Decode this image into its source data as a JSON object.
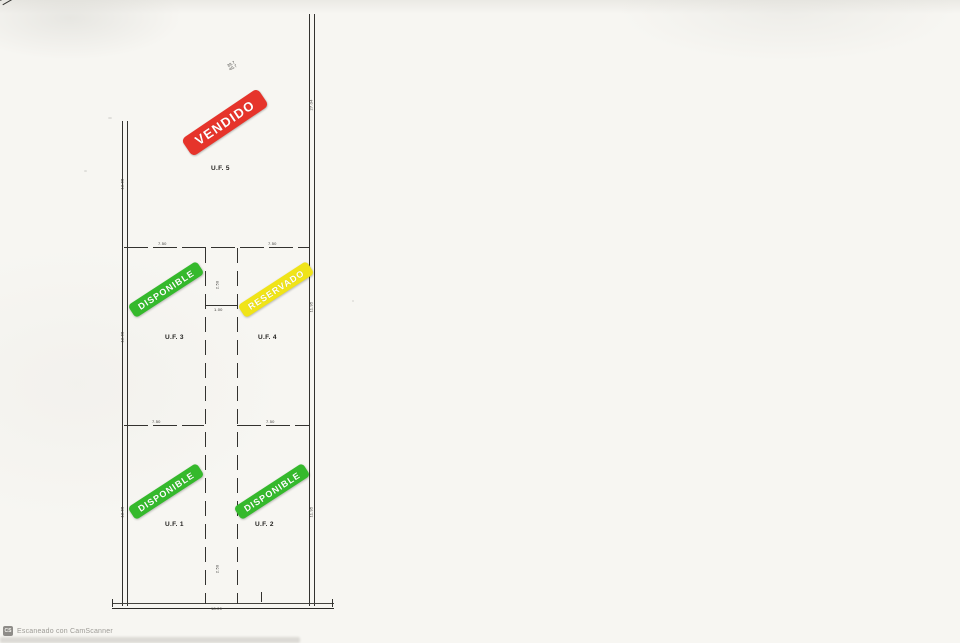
{
  "watermark": {
    "icon_text": "CS",
    "text": "Escaneado con CamScanner"
  },
  "plan": {
    "units": [
      {
        "id": "uf5",
        "label": "U.F. 5",
        "status": "VENDIDO",
        "status_color": "#e6342b"
      },
      {
        "id": "uf3",
        "label": "U.F. 3",
        "status": "DISPONIBLE",
        "status_color": "#35b92c"
      },
      {
        "id": "uf4",
        "label": "U.F. 4",
        "status": "RESERVADO",
        "status_color": "#f0e418"
      },
      {
        "id": "uf1",
        "label": "U.F. 1",
        "status": "DISPONIBLE",
        "status_color": "#35b92c"
      },
      {
        "id": "uf2",
        "label": "U.F. 2",
        "status": "DISPONIBLE",
        "status_color": "#35b92c"
      }
    ],
    "dimensions": {
      "top_slant": [
        "39.7",
        "40.7"
      ],
      "left_edge": [
        "13.65",
        "12.65",
        "12.65"
      ],
      "right_edge": [
        "27.04",
        "11.95",
        "11.95"
      ],
      "bottom": "18.00",
      "divider_upper": [
        "7.50",
        "7.50"
      ],
      "divider_lower": [
        "7.50",
        "7.50"
      ],
      "corridor_width": "1.00",
      "corridor_height": [
        "2.50",
        "2.50"
      ]
    }
  }
}
